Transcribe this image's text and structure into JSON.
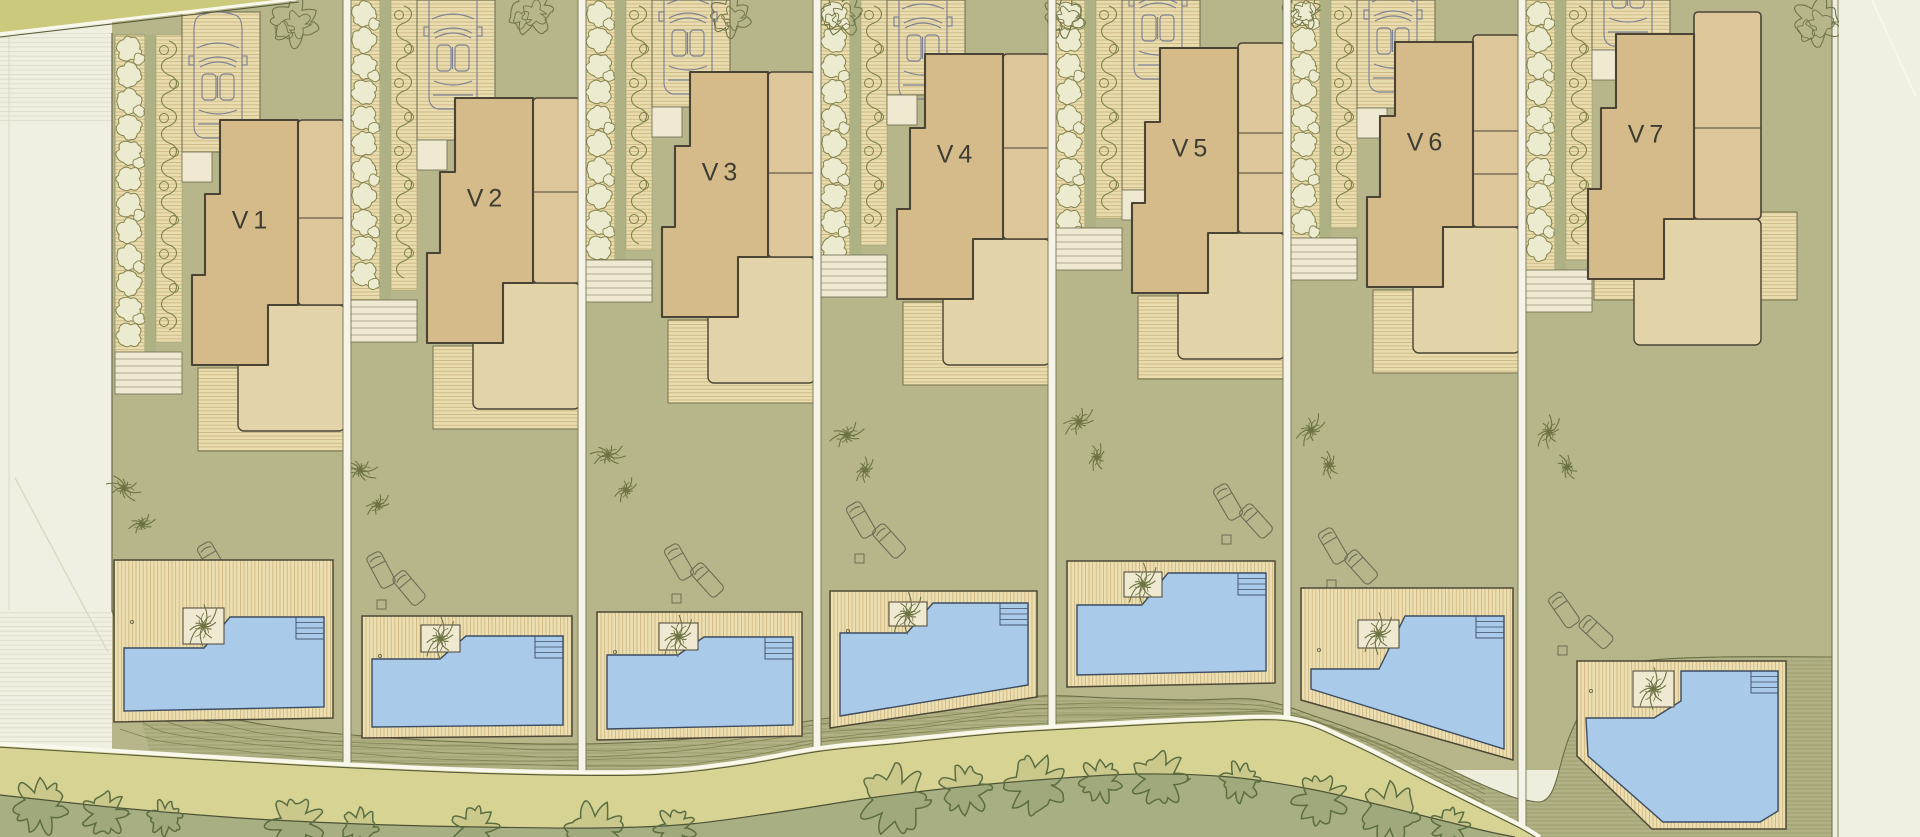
{
  "plan_title": "Villa site plan",
  "palette": {
    "margin": "#f0efe1",
    "marginLine": "#e1decb",
    "topRoad": "#cbc97c",
    "road": "#d6d393",
    "roadLine": "#faf8ec",
    "roadDark": "#585a3b",
    "bushBand": "#a8af83",
    "bushStroke": "#5b6e42",
    "garden": "#b7b68a",
    "gardenStrip": "#adb183",
    "boardsBg": "#e9dcae",
    "boardsLine": "#c9b37e",
    "emb": "#b1b185",
    "embLine": "#757948",
    "embTop": "#6a6e45",
    "outline": "#4b4434",
    "thin": "#6b6b4e",
    "mainFill": "#d5bb8a",
    "colFill": "#dcc69a",
    "terrace": "#e3d3a9",
    "cream": "#efe9d2",
    "hedgeFill": "#eceacf",
    "hedgeStroke": "#84854e",
    "vine": "#7d8148",
    "palm": "#6e7342",
    "tree": "#707547",
    "pool": "#a9cae8",
    "poolStroke": "#3c4c62",
    "deckStroke": "#4d4836",
    "label": "#3d3d31",
    "car": "#7d8195",
    "lounger": "#6c6c57",
    "sepFill": "#f6f4e8",
    "sepLine": "#77774f",
    "boundary": "#6a6a4c"
  },
  "site": {
    "width": 1920,
    "height": 837,
    "left_margin_x": 112,
    "right_edge_x": 1832,
    "top_band": {
      "poly": [
        [
          0,
          0
        ],
        [
          295,
          0
        ],
        [
          0,
          33
        ]
      ]
    },
    "separators": [
      347,
      582,
      817,
      1052,
      1287,
      1522
    ],
    "separator_end_y": [
      766,
      774,
      758,
      727,
      718,
      826
    ],
    "road_top": [
      [
        0,
        744
      ],
      [
        150,
        753
      ],
      [
        300,
        762
      ],
      [
        450,
        769
      ],
      [
        570,
        772
      ],
      [
        660,
        771
      ],
      [
        740,
        762
      ],
      [
        820,
        748
      ],
      [
        900,
        740
      ],
      [
        1000,
        730
      ],
      [
        1100,
        724
      ],
      [
        1200,
        719
      ],
      [
        1290,
        718
      ],
      [
        1350,
        740
      ],
      [
        1420,
        775
      ],
      [
        1480,
        805
      ],
      [
        1520,
        825
      ],
      [
        1540,
        837
      ]
    ],
    "emb_top": [
      [
        112,
        610
      ],
      [
        135,
        672
      ],
      [
        185,
        706
      ],
      [
        260,
        724
      ],
      [
        340,
        734
      ],
      [
        440,
        741
      ],
      [
        540,
        744
      ],
      [
        620,
        743
      ],
      [
        700,
        738
      ],
      [
        770,
        728
      ],
      [
        830,
        718
      ],
      [
        900,
        715
      ],
      [
        970,
        706
      ],
      [
        1040,
        696
      ],
      [
        1110,
        698
      ],
      [
        1190,
        700
      ],
      [
        1260,
        700
      ],
      [
        1320,
        718
      ],
      [
        1380,
        740
      ],
      [
        1440,
        765
      ],
      [
        1490,
        788
      ],
      [
        1525,
        800
      ],
      [
        1550,
        795
      ],
      [
        1570,
        735
      ],
      [
        1600,
        680
      ],
      [
        1640,
        662
      ],
      [
        1720,
        657
      ],
      [
        1832,
        657
      ]
    ],
    "bush_top": [
      [
        0,
        795
      ],
      [
        120,
        808
      ],
      [
        240,
        818
      ],
      [
        360,
        824
      ],
      [
        480,
        827
      ],
      [
        600,
        828
      ],
      [
        690,
        824
      ],
      [
        780,
        812
      ],
      [
        870,
        798
      ],
      [
        960,
        787
      ],
      [
        1050,
        779
      ],
      [
        1140,
        774
      ],
      [
        1230,
        777
      ],
      [
        1310,
        789
      ],
      [
        1380,
        805
      ],
      [
        1440,
        820
      ],
      [
        1490,
        832
      ],
      [
        1515,
        837
      ]
    ],
    "bushes": [
      [
        40,
        806,
        22
      ],
      [
        105,
        814,
        18
      ],
      [
        165,
        818,
        14
      ],
      [
        295,
        824,
        22
      ],
      [
        360,
        827,
        15
      ],
      [
        475,
        828,
        18
      ],
      [
        595,
        832,
        24
      ],
      [
        675,
        828,
        16
      ],
      [
        895,
        800,
        28
      ],
      [
        965,
        790,
        20
      ],
      [
        1035,
        785,
        24
      ],
      [
        1100,
        781,
        17
      ],
      [
        1160,
        779,
        22
      ],
      [
        1240,
        782,
        16
      ],
      [
        1320,
        800,
        21
      ],
      [
        1390,
        813,
        24
      ],
      [
        1450,
        826,
        15
      ]
    ],
    "margin_diag": [
      [
        15,
        478
      ],
      [
        108,
        652
      ]
    ],
    "right_diag": [
      [
        1872,
        0
      ],
      [
        1916,
        97
      ]
    ]
  },
  "plots": [
    {
      "label": "V1",
      "x": 112,
      "w": 235,
      "b": 114,
      "car_y": 14,
      "drv_end": 152,
      "drv_top": 12,
      "hf": 35,
      "ht": 352,
      "dx": 0,
      "colw": 0,
      "cdy": 0,
      "col_lines": [
        104
      ],
      "trees": [
        [
          182,
          22,
          20
        ]
      ],
      "palms": [
        [
          12,
          488
        ],
        [
          30,
          524
        ]
      ],
      "loungers": [
        [
          100,
          560,
          -30
        ],
        [
          128,
          580,
          -42
        ]
      ],
      "table": [
        88,
        592
      ],
      "pool": {
        "x": 2,
        "y": 560,
        "w": 219,
        "bl": 162,
        "br": 158,
        "planter": [
          69,
          48,
          41,
          36
        ],
        "tl": 88,
        "tr": 57,
        "pb": 11,
        "dot": [
          18,
          62
        ]
      }
    },
    {
      "label": "V2",
      "x": 347,
      "w": 235,
      "b": 92,
      "car_y": -15,
      "drv_end": 140,
      "drv_top": 0,
      "hf": 0,
      "ht": 300,
      "dx": 0,
      "colw": 0,
      "cdy": 0,
      "col_lines": [
        100
      ],
      "trees": [
        [
          184,
          12,
          19
        ]
      ],
      "palms": [
        [
          13,
          470
        ],
        [
          31,
          505
        ]
      ],
      "loungers": [
        [
          34,
          570,
          -28
        ],
        [
          62,
          588,
          -40
        ]
      ],
      "table": [
        30,
        600
      ],
      "pool": {
        "x": 15,
        "y": 616,
        "w": 210,
        "bl": 122,
        "br": 120,
        "planter": [
          59,
          9,
          39,
          27
        ],
        "tl": 43,
        "tr": 20,
        "pb": 11,
        "dot": [
          18,
          40
        ]
      }
    },
    {
      "label": "V3",
      "x": 582,
      "w": 235,
      "b": 66,
      "car_y": -30,
      "drv_end": 107,
      "drv_top": 0,
      "hf": 0,
      "ht": 260,
      "dx": 0,
      "colw": 0,
      "cdy": 0,
      "col_lines": [
        107
      ],
      "trees": [
        [
          148,
          16,
          17
        ]
      ],
      "palms": [
        [
          26,
          455
        ],
        [
          44,
          490
        ]
      ],
      "loungers": [
        [
          97,
          562,
          -30
        ],
        [
          125,
          580,
          -42
        ]
      ],
      "table": [
        90,
        594
      ],
      "pool": {
        "x": 15,
        "y": 612,
        "w": 205,
        "bl": 128,
        "br": 124,
        "planter": [
          62,
          11,
          39,
          27
        ],
        "tl": 43,
        "tr": 25,
        "pb": 11,
        "dot": [
          18,
          40
        ]
      }
    },
    {
      "label": "V4",
      "x": 817,
      "w": 235,
      "b": 48,
      "car_y": -25,
      "drv_end": 95,
      "drv_top": 0,
      "hf": 0,
      "ht": 255,
      "dx": 0,
      "colw": 0,
      "cdy": 0,
      "col_lines": [
        100
      ],
      "trees": [
        [
          24,
          14,
          18
        ]
      ],
      "palms": [
        [
          30,
          435
        ],
        [
          48,
          470
        ]
      ],
      "loungers": [
        [
          44,
          520,
          -30
        ],
        [
          72,
          541,
          -42
        ]
      ],
      "table": [
        38,
        554
      ],
      "pool": {
        "x": 13,
        "y": 591,
        "w": 207,
        "bl": 137,
        "br": 106,
        "planter": [
          59,
          11,
          38,
          24
        ],
        "tl": 42,
        "tr": 12,
        "pb": 12,
        "dot": [
          18,
          40
        ]
      }
    },
    {
      "label": "V5",
      "x": 1052,
      "w": 235,
      "b": 42,
      "car_y": -45,
      "drv_end": 190,
      "drv_top": 0,
      "hf": 0,
      "ht": 228,
      "dx": 0,
      "colw": 0,
      "cdy": -5,
      "col_lines": [
        91,
        131
      ],
      "trees": [
        [
          12,
          16,
          17
        ]
      ],
      "palms": [
        [
          27,
          422
        ],
        [
          45,
          457
        ]
      ],
      "loungers": [
        [
          176,
          502,
          -30
        ],
        [
          204,
          521,
          -42
        ]
      ],
      "table": [
        170,
        535
      ],
      "pool": {
        "x": 15,
        "y": 561,
        "w": 208,
        "bl": 126,
        "br": 122,
        "planter": [
          57,
          11,
          38,
          25
        ],
        "tl": 44,
        "tr": 12,
        "pb": 12,
        "dot": [
          18,
          62
        ]
      }
    },
    {
      "label": "V6",
      "x": 1287,
      "w": 235,
      "b": 36,
      "car_y": -32,
      "drv_end": 108,
      "drv_top": 0,
      "hf": 0,
      "ht": 238,
      "dx": 0,
      "colw": 0,
      "cdy": -7,
      "col_lines": [
        95,
        138
      ],
      "trees": [
        [
          14,
          10,
          16
        ]
      ],
      "palms": [
        [
          24,
          430
        ],
        [
          42,
          465
        ]
      ],
      "loungers": [
        [
          46,
          546,
          -30
        ],
        [
          74,
          567,
          -42
        ]
      ],
      "table": [
        40,
        580
      ],
      "pool": {
        "x": 14,
        "y": 588,
        "w": 212,
        "bl": 112,
        "br": 172,
        "planter": [
          57,
          32,
          41,
          28
        ],
        "tl": 81,
        "tr": 28,
        "pb": 11,
        "dot": [
          18,
          62
        ]
      }
    },
    {
      "label": "V7",
      "x": 1522,
      "w": 310,
      "b": 28,
      "car_y": -78,
      "drv_end": 50,
      "drv_top": 0,
      "hf": 0,
      "ht": 270,
      "dx": -14,
      "colw": 20,
      "cdy": -22,
      "col_lines": [
        100
      ],
      "trees": [
        [
          295,
          22,
          20
        ]
      ],
      "palms": [
        [
          27,
          432
        ],
        [
          45,
          467
        ]
      ],
      "loungers": [
        [
          42,
          610,
          -35
        ],
        [
          74,
          632,
          -47
        ]
      ],
      "table": [
        36,
        646
      ],
      "patio": [
        72,
        212,
        203,
        88
      ],
      "pool": {
        "x": 55,
        "y": 661,
        "w": 209,
        "planter": [
          56,
          10,
          41,
          36
        ],
        "dot": [
          14,
          30
        ],
        "deckPath": "M0,0 L209,0 L209,168 L75,168 L0,95 Z",
        "poolPath": "M9,57 L77,57 L104,40 L104,10 L201,10 L201,150 L183,161 L86,161 L11,95 Z",
        "steps": [
          174,
          10,
          27,
          22
        ]
      }
    }
  ]
}
